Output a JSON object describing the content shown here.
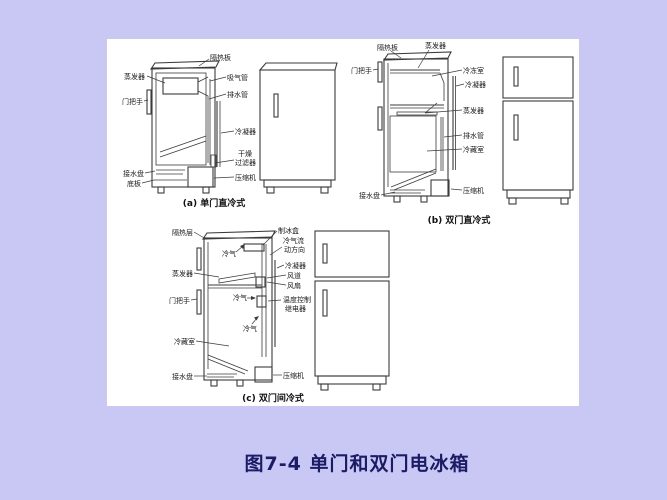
{
  "colors": {
    "background": "#c9c7f4",
    "panel": "#ffffff",
    "line": "#3b3b3b",
    "label_text": "#1a1a1a",
    "caption_text": "#111111",
    "figure_caption": "#1b1b66"
  },
  "figure": {
    "caption": "图7-4  单门和双门电冰箱"
  },
  "diagram_a": {
    "caption": "(a) 单门直冷式",
    "labels": {
      "insulation_board": "隔热板",
      "evaporator": "蒸发器",
      "door_handle": "门把手",
      "suction_pipe": "吸气管",
      "drain_pipe": "排水管",
      "condenser": "冷凝器",
      "dryer_filter_line1": "干燥",
      "dryer_filter_line2": "过滤器",
      "compressor": "压缩机",
      "water_tray": "接水盘",
      "bottom_plate": "底板"
    }
  },
  "diagram_b": {
    "caption": "(b) 双门直冷式",
    "labels": {
      "insulation_board": "隔热板",
      "evaporator_top": "蒸发器",
      "door_handle": "门把手",
      "freezer_compartment": "冷冻室",
      "condenser": "冷凝器",
      "evaporator_mid": "蒸发器",
      "drain_pipe": "排水管",
      "refrigerating_compartment": "冷藏室",
      "compressor": "压缩机",
      "water_tray": "接水盘"
    }
  },
  "diagram_c": {
    "caption": "(c) 双门间冷式",
    "labels": {
      "insulation_layer": "隔热层",
      "ice_box": "制冰盒",
      "airflow_line1": "冷气流",
      "airflow_line2": "动方向",
      "cold_air_top": "冷气",
      "condenser": "冷凝器",
      "evaporator": "蒸发器",
      "air_duct": "风道",
      "fan": "风扇",
      "cold_air_mid": "冷气",
      "door_handle": "门把手",
      "thermostat_line1": "温度控制",
      "thermostat_line2": "继电器",
      "cold_air_low": "冷气",
      "refrigerating_compartment": "冷藏室",
      "water_tray": "接水盘",
      "compressor": "压缩机"
    }
  }
}
